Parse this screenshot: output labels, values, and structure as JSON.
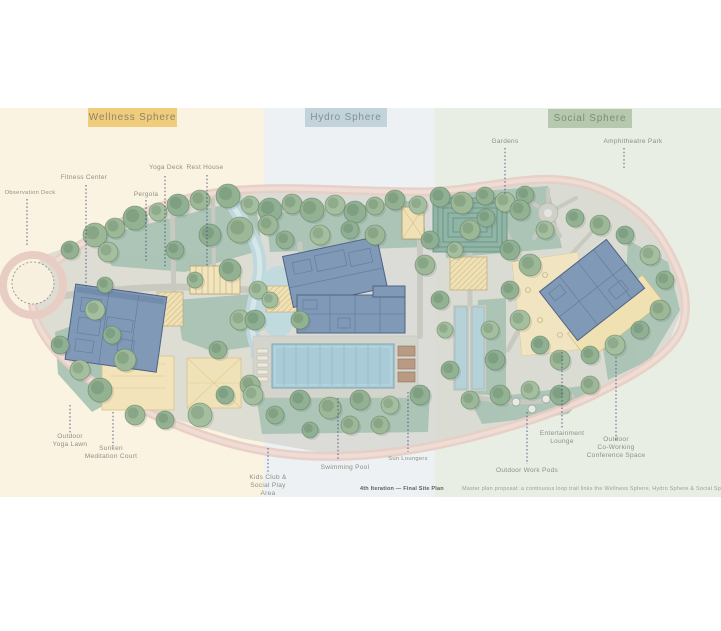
{
  "zones": [
    {
      "id": "wellness",
      "label": "Wellness Sphere",
      "band_color": "#fbf3e1",
      "chip_color": "#efcd7d"
    },
    {
      "id": "hydro",
      "label": "Hydro Sphere",
      "band_color": "#edf1f4",
      "chip_color": "#c2d3d9"
    },
    {
      "id": "social",
      "label": "Social Sphere",
      "band_color": "#e9eee4",
      "chip_color": "#b6c9ae"
    }
  ],
  "labels": {
    "observation_deck": {
      "lines": [
        "Observation Deck"
      ]
    },
    "fitness_center": {
      "lines": [
        "Fitness Center"
      ]
    },
    "yoga_deck": {
      "lines": [
        "Yoga Deck"
      ]
    },
    "rest_house": {
      "lines": [
        "Rest House"
      ]
    },
    "pergola": {
      "lines": [
        "Pergola"
      ]
    },
    "outdoor_yoga_lawn": {
      "lines": [
        "Outdoor",
        "Yoga Lawn"
      ]
    },
    "meditation_court": {
      "lines": [
        "Sunken",
        "Meditation Court"
      ]
    },
    "kids_club": {
      "lines": [
        "Kids Club &",
        "Social Play",
        "Area"
      ]
    },
    "swimming_pool": {
      "lines": [
        "Swimming Pool"
      ]
    },
    "sun_loungers": {
      "lines": [
        "Sun Loungers"
      ]
    },
    "gardens": {
      "lines": [
        "Gardens"
      ]
    },
    "amphitheatre_park": {
      "lines": [
        "Amphitheatre Park"
      ]
    },
    "entertainment_lounge": {
      "lines": [
        "Entertainment",
        "Lounge"
      ]
    },
    "outdoor_coworking": {
      "lines": [
        "Outdoor",
        "Co-Working",
        "Conference Space"
      ]
    },
    "outdoor_work_pods": {
      "lines": [
        "Outdoor Work Pods"
      ]
    }
  },
  "caption": {
    "left": "4th Iteration — Final Site Plan",
    "right": "Master plan proposal: a continuous loop trail links the Wellness Sphere, Hydro Sphere & Social Sphere around a central stream, pool deck and co-working gardens — Scale 1:500"
  },
  "palette": {
    "road": "#e7cdc4",
    "water": "#bed8dd",
    "building_blue": "#8099b7",
    "deck_yellow": "#f0e1b2",
    "lawn": "#a6c2b2",
    "leader": "#3d4e7a"
  }
}
